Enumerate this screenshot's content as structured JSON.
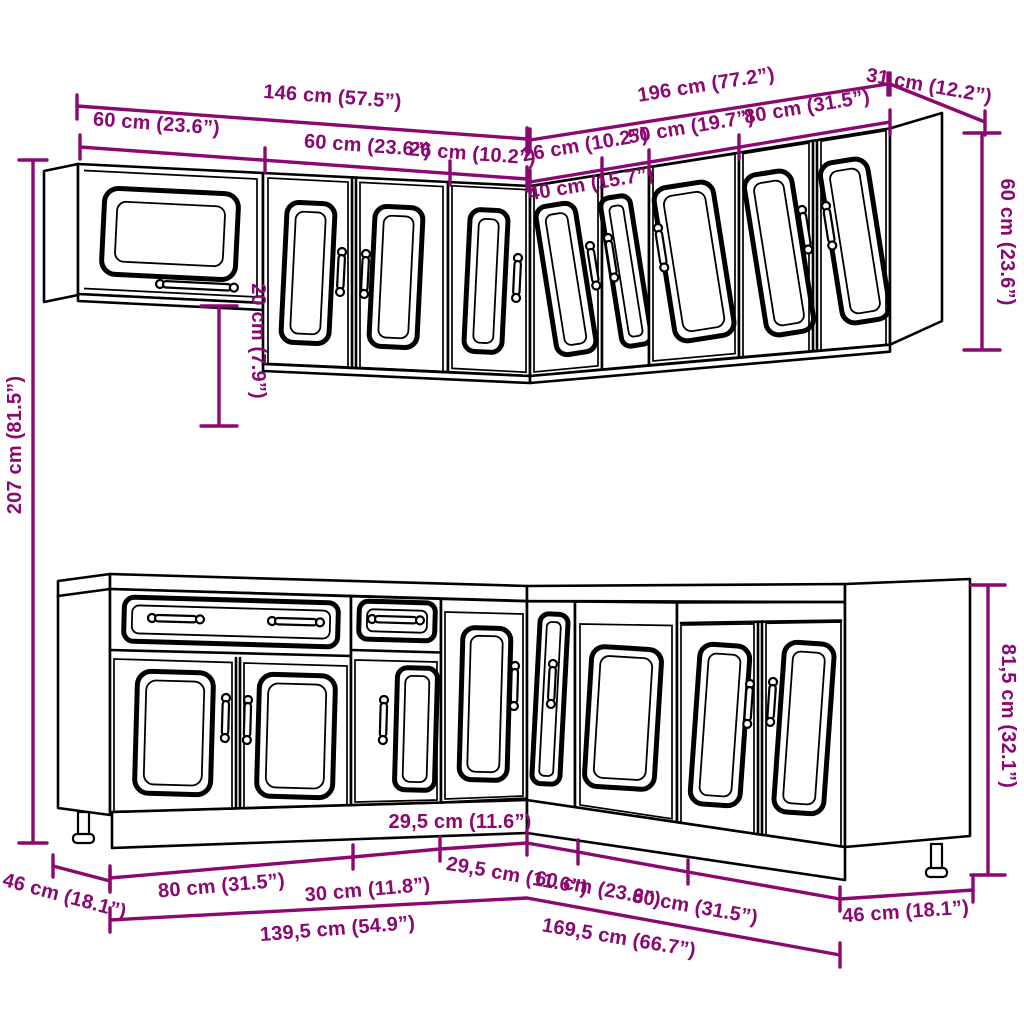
{
  "accent_color": "#8B0870",
  "line_color": "#000000",
  "background_color": "#FFFFFF",
  "diagram": "kitchen-cabinet-set-dimension-drawing",
  "dimensions": {
    "wall": {
      "left_total": "146 cm (57.5”)",
      "left_cabinet_glass": "60 cm (23.6”)",
      "left_cabinet_double": "60 cm (23.6”)",
      "left_cabinet_narrow": "26 cm (10.2”)",
      "right_total": "196 cm (77.2”)",
      "right_corner": "40 cm (15.7”)",
      "right_narrow": "26 cm (10.2”)",
      "right_single": "50 cm (19.7”)",
      "right_double": "80 cm (31.5”)",
      "right_depth": "31 cm (12.2”)",
      "height": "60 cm (23.6”)",
      "glass_offset": "20 cm (7.9”)"
    },
    "overall": {
      "total_height": "207 cm (81.5”)"
    },
    "base": {
      "left_depth": "46 cm (18.1”)",
      "left_double": "80 cm (31.5”)",
      "left_single": "30 cm (11.8”)",
      "left_corner": "29,5 cm (11.6”)",
      "left_total": "139,5 cm (54.9”)",
      "right_corner": "29,5 cm (11.6”)",
      "right_sink": "60 cm (23.6”)",
      "right_double": "80 cm (31.5”)",
      "right_depth": "46 cm (18.1”)",
      "right_total": "169,5 cm (66.7”)",
      "height": "81,5 cm (32.1”)"
    }
  }
}
